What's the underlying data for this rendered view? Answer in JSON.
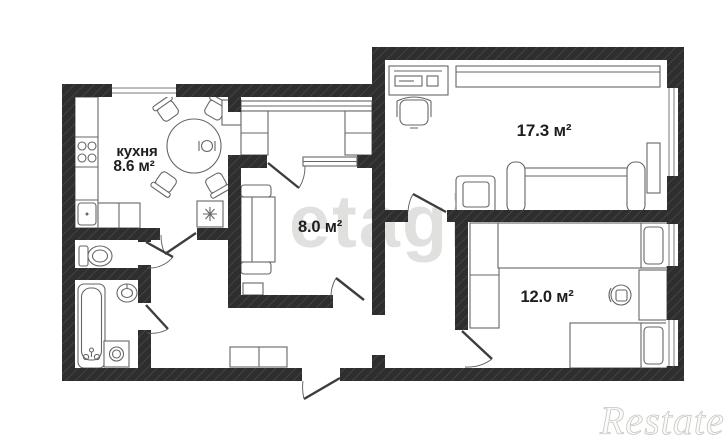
{
  "plan": {
    "rooms": [
      {
        "id": "kitchen",
        "label": "кухня",
        "area": "8.6 м²"
      },
      {
        "id": "living-room",
        "area": "17.3 м²"
      },
      {
        "id": "small-room",
        "area": "8.0 м²"
      },
      {
        "id": "bedroom",
        "area": "12.0 м²"
      }
    ],
    "watermarks": {
      "center": "etagi",
      "corner": "Restate"
    },
    "colors": {
      "wall": "#2e2e2e",
      "wall_hatch": "#484848",
      "background": "#ffffff",
      "furniture_line": "#666666",
      "label_text": "#1e1e1e",
      "watermark_center": "#e0e0df",
      "watermark_corner_stroke": "#c6c6c2"
    }
  }
}
